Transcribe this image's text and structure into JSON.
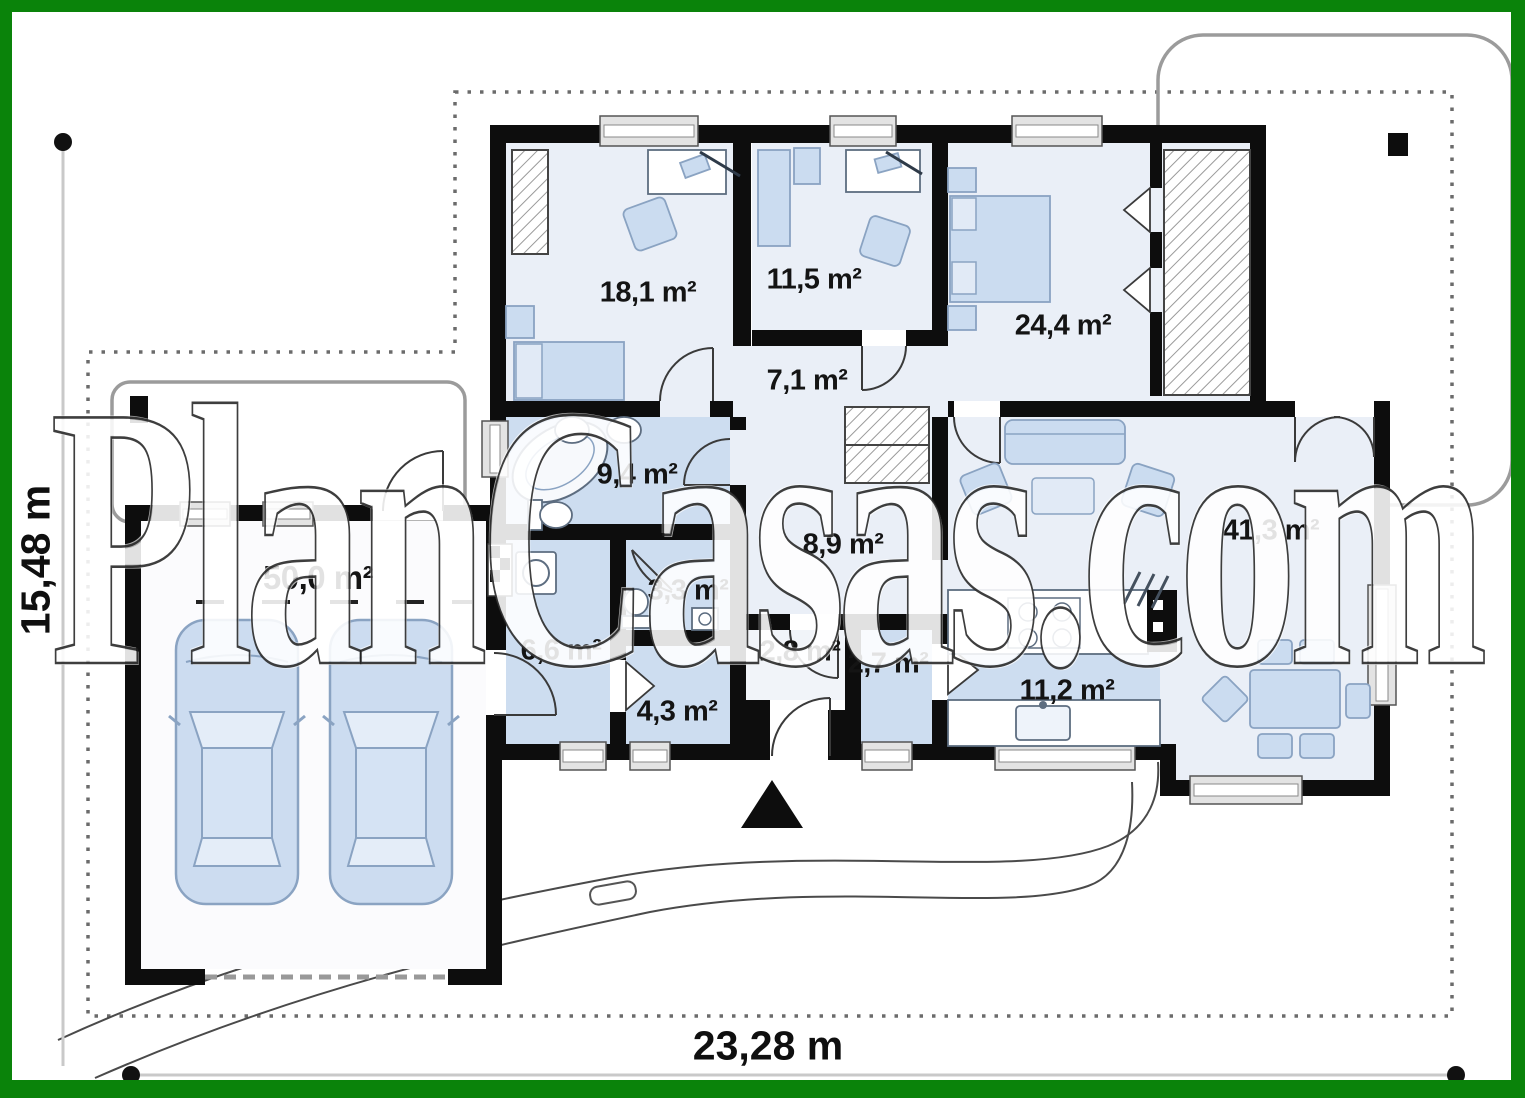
{
  "plan": {
    "watermark": "PlanCasas.com",
    "dimensions": {
      "width": "23,28 m",
      "height": "15,48 m"
    },
    "rooms": [
      {
        "id": "bedroom-1",
        "area": "18,1 m²"
      },
      {
        "id": "bedroom-2",
        "area": "11,5 m²"
      },
      {
        "id": "master-bedroom",
        "area": "24,4 m²"
      },
      {
        "id": "hall",
        "area": "7,1 m²"
      },
      {
        "id": "bathroom",
        "area": "9,4 m²"
      },
      {
        "id": "corridor",
        "area": "8,9 m²"
      },
      {
        "id": "toilet",
        "area": "3,3 m²"
      },
      {
        "id": "garage",
        "area": "50,0 m²"
      },
      {
        "id": "garage-hall",
        "area": "6,6 m²"
      },
      {
        "id": "vestibule",
        "area": "2,8 m²"
      },
      {
        "id": "pantry",
        "area": "2,7 m²"
      },
      {
        "id": "closet",
        "area": "4,3 m²"
      },
      {
        "id": "kitchen",
        "area": "11,2 m²"
      },
      {
        "id": "living-room",
        "area": "41,3 m²"
      }
    ],
    "colors": {
      "frame": "#0a830a",
      "walls": "#0d0d0d",
      "floor_light": "#eaeff7",
      "floor_blue": "#cdddf0",
      "furniture": "#cbdcf0"
    }
  }
}
